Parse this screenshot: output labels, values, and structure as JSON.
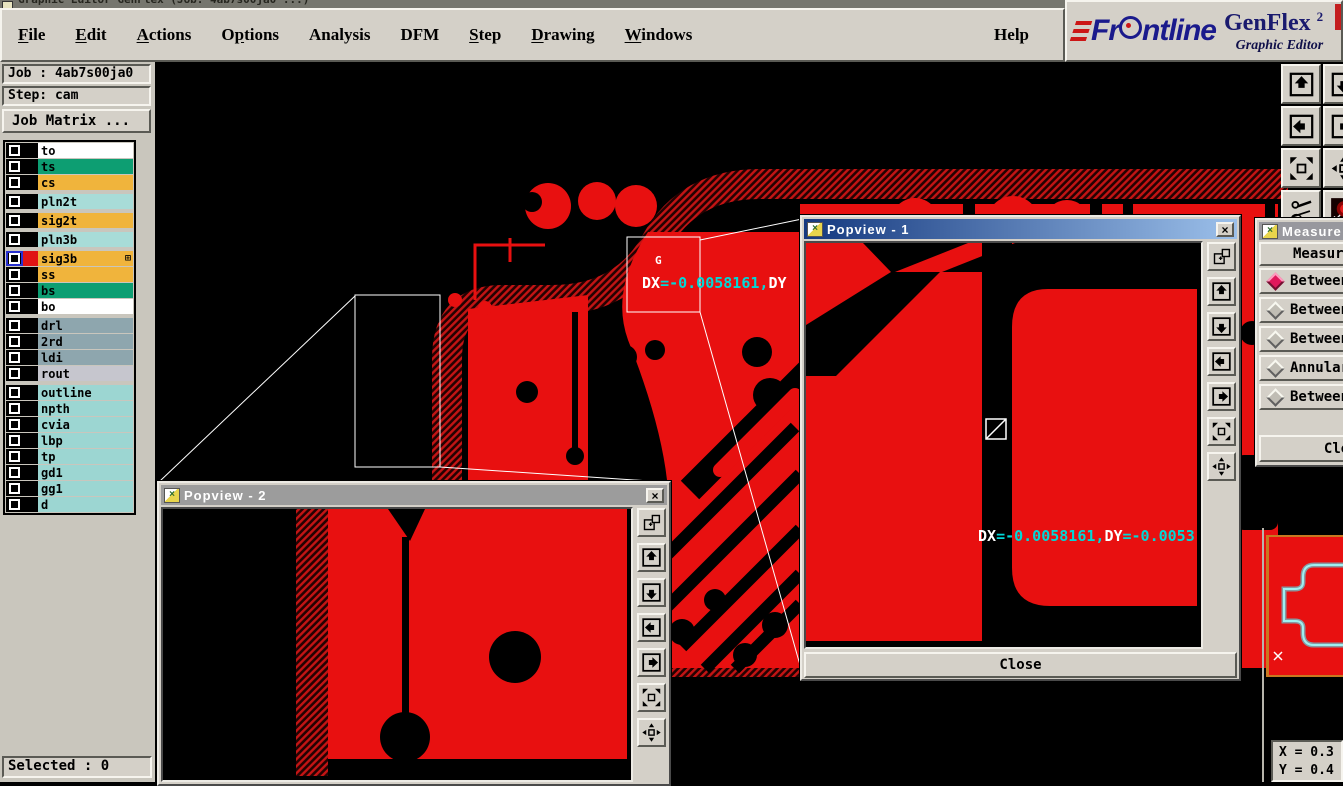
{
  "window": {
    "title": "Graphic Editor GenFlex (Job: 4ab7s00ja0 ...)"
  },
  "menu": {
    "items": [
      {
        "label": "File",
        "u": 0
      },
      {
        "label": "Edit",
        "u": 0
      },
      {
        "label": "Actions",
        "u": 0
      },
      {
        "label": "Options",
        "u": 1
      },
      {
        "label": "Analysis",
        "u": -1
      },
      {
        "label": "DFM",
        "u": -1
      },
      {
        "label": "Step",
        "u": 0
      },
      {
        "label": "Drawing",
        "u": 0
      },
      {
        "label": "Windows",
        "u": 0
      }
    ],
    "help": {
      "label": "Help"
    }
  },
  "logo": {
    "brand_prefix": "Fr",
    "brand_suffix": "ntline",
    "product": "GenFlex",
    "sup": "2",
    "tagline": "Graphic Editor"
  },
  "job_panel": {
    "job": "Job : 4ab7s00ja0",
    "step": "Step: cam",
    "matrix_button": "Job Matrix ..."
  },
  "layers": {
    "groups": [
      [
        {
          "name": "to",
          "color": "#ffffff"
        },
        {
          "name": "ts",
          "color": "#0d9e72"
        },
        {
          "name": "cs",
          "color": "#f0b43c"
        }
      ],
      [
        {
          "name": "pln2t",
          "color": "#a8dcd8"
        }
      ],
      [
        {
          "name": "sig2t",
          "color": "#f0b43c"
        }
      ],
      [
        {
          "name": "pln3b",
          "color": "#a8dcd8"
        }
      ],
      [
        {
          "name": "sig3b",
          "color": "#f0b43c",
          "selected": true,
          "swatch": "#e01414",
          "badge": "⊞"
        },
        {
          "name": "ss",
          "color": "#f0b43c"
        },
        {
          "name": "bs",
          "color": "#0d9e72"
        },
        {
          "name": "bo",
          "color": "#ffffff"
        }
      ],
      [
        {
          "name": "drl",
          "color": "#8ea6ae"
        },
        {
          "name": "2rd",
          "color": "#8ea6ae"
        },
        {
          "name": "ldi",
          "color": "#8ea6ae"
        },
        {
          "name": "rout",
          "color": "#c6c6ce"
        }
      ],
      [
        {
          "name": "outline",
          "color": "#9cd6d2"
        },
        {
          "name": "npth",
          "color": "#9cd6d2"
        },
        {
          "name": "cvia",
          "color": "#9cd6d2"
        },
        {
          "name": "lbp",
          "color": "#9cd6d2"
        },
        {
          "name": "tp",
          "color": "#9cd6d2"
        },
        {
          "name": "gd1",
          "color": "#9cd6d2"
        },
        {
          "name": "gg1",
          "color": "#9cd6d2"
        },
        {
          "name": "d",
          "color": "#9cd6d2"
        }
      ]
    ]
  },
  "canvas": {
    "g_marker": "G",
    "measure_label": {
      "dx": "DX",
      "v1": "=-0.0058161,",
      "dy": "DY"
    }
  },
  "popview1": {
    "title": "Popview - 1",
    "close_glyph": "×",
    "close_button": "Close",
    "measure_label": {
      "dx": "DX",
      "v1": "=-0.0058161,",
      "dy": "DY",
      "v2": "=-0.0053"
    }
  },
  "popview2": {
    "title": "Popview - 2",
    "close_glyph": "×"
  },
  "measure_panel": {
    "title": "Measure Po",
    "header": "Measure",
    "options": [
      {
        "label": "Between",
        "selected": true
      },
      {
        "label": "Between",
        "selected": false
      },
      {
        "label": "Between",
        "selected": false
      },
      {
        "label": "Annular",
        "selected": false
      },
      {
        "label": "Between",
        "selected": false
      }
    ],
    "close_button": "Close"
  },
  "status": {
    "selected": "Selected : 0",
    "x": "X = 0.3",
    "y": "Y = 0.4"
  },
  "toolbars": {
    "main": [
      [
        "pan-up",
        "pan-down"
      ],
      [
        "pan-left",
        "pan-right"
      ],
      [
        "zoom-extents",
        "center-view"
      ],
      [
        "tools",
        "highlight"
      ]
    ],
    "popview": [
      "duplicate-view",
      "pan-up",
      "pan-down",
      "pan-left",
      "pan-right",
      "zoom-extents",
      "center-view"
    ]
  },
  "colors": {
    "copper_red": "#e81010",
    "hatch_red": "#c41414",
    "measure_cyan": "#00d8d8",
    "title_blue": "#15397f",
    "accent_navy": "#1a1a8c",
    "selected_radio": "#e0185c"
  }
}
